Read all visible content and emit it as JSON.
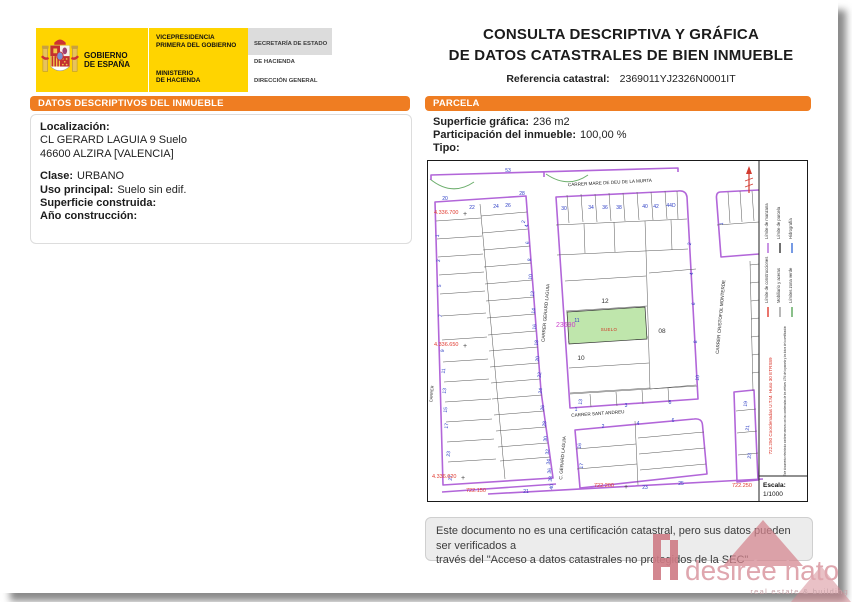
{
  "header": {
    "agency": {
      "gobierno": "GOBIERNO\nDE ESPAÑA",
      "vicepresidencia": "VICEPRESIDENCIA\nPRIMERA DEL GOBIERNO",
      "ministerio": "MINISTERIO\nDE HACIENDA",
      "secretaria": "SECRETARÍA DE ESTADO\nDE HACIENDA",
      "direccion": "DIRECCIÓN GENERAL\nDEL CATASTRO"
    },
    "title_line1": "CONSULTA DESCRIPTIVA Y GRÁFICA",
    "title_line2": "DE DATOS CATASTRALES DE BIEN INMUEBLE",
    "referencia_label": "Referencia catastral:",
    "referencia_value": "2369011YJ2326N0001IT"
  },
  "datos": {
    "title": "DATOS DESCRIPTIVOS DEL INMUEBLE",
    "localizacion_label": "Localización:",
    "direccion_line1": "CL GERARD LAGUIA 9 Suelo",
    "direccion_line2": "46600 ALZIRA [VALENCIA]",
    "clase_label": "Clase:",
    "clase_value": "URBANO",
    "uso_label": "Uso principal:",
    "uso_value": "Suelo sin edif.",
    "superficie_label": "Superficie construida:",
    "superficie_value": "",
    "anio_label": "Año construcción:",
    "anio_value": ""
  },
  "parcela": {
    "title": "PARCELA",
    "superficie_label": "Superficie gráfica:",
    "superficie_value": "236 m2",
    "participacion_label": "Participación del inmueble:",
    "participacion_value": "100,00 %",
    "tipo_label": "Tipo:",
    "tipo_value": ""
  },
  "map": {
    "scale_label": "Escala:",
    "scale_value": "1/1000",
    "side_note_red": "722.250 Coordenadas U.T.M. Huso 30 ETRS89",
    "side_note_black": "Este documento electrónico contiene anexos con las coordenadas de los vértices UTM de la parcela y los datos de la certificación",
    "legend": [
      {
        "label": "Límite de manzana",
        "color": "#b266d9"
      },
      {
        "label": "Límite de construcciones",
        "color": "#e03a2f"
      },
      {
        "label": "Límite de parcela",
        "color": "#333333"
      },
      {
        "label": "Mobiliario y aceras",
        "color": "#999999"
      },
      {
        "label": "Hidrografía",
        "color": "#3b6fd8"
      },
      {
        "label": "Límites zona verde",
        "color": "#57a657"
      }
    ],
    "labels": [
      {
        "t": "CARRER MARE DE DEU DE LA MURTA",
        "x": 182,
        "y": 23,
        "r": -3,
        "c": "street"
      },
      {
        "t": "CARRER GERARD LAGUIA",
        "x": 119,
        "y": 152,
        "r": -85,
        "c": "street"
      },
      {
        "t": "CARRER CRISTOFOL MONTERDE",
        "x": 294,
        "y": 156,
        "r": -85,
        "c": "street"
      },
      {
        "t": "CARRER SANT ANDREU",
        "x": 170,
        "y": 254,
        "r": -4,
        "c": "street"
      },
      {
        "t": "C. GERARD LAGUIA",
        "x": 136,
        "y": 297,
        "r": -85,
        "c": "street"
      },
      {
        "t": "CARRER",
        "x": 5,
        "y": 233,
        "r": -85,
        "c": "street",
        "s": 4
      },
      {
        "t": "53",
        "x": 80,
        "y": 11
      },
      {
        "t": "20",
        "x": 17,
        "y": 39
      },
      {
        "t": "28",
        "x": 94,
        "y": 34
      },
      {
        "t": "22",
        "x": 44,
        "y": 48
      },
      {
        "t": "24",
        "x": 68,
        "y": 47
      },
      {
        "t": "26",
        "x": 80,
        "y": 46
      },
      {
        "t": "2",
        "x": 97,
        "y": 61,
        "r": -80
      },
      {
        "t": "1",
        "x": 11,
        "y": 75,
        "r": -84
      },
      {
        "t": "3",
        "x": 12,
        "y": 100,
        "r": -84
      },
      {
        "t": "5",
        "x": 13,
        "y": 125,
        "r": -84
      },
      {
        "t": "7",
        "x": 14,
        "y": 155,
        "r": -84
      },
      {
        "t": "9",
        "x": 16,
        "y": 190,
        "r": -84
      },
      {
        "t": "11",
        "x": 17,
        "y": 210,
        "r": -84
      },
      {
        "t": "13",
        "x": 18,
        "y": 230,
        "r": -84
      },
      {
        "t": "15",
        "x": 19,
        "y": 249,
        "r": -84
      },
      {
        "t": "17",
        "x": 20,
        "y": 265,
        "r": -84
      },
      {
        "t": "23",
        "x": 22,
        "y": 293,
        "r": -84
      },
      {
        "t": "27",
        "x": 24,
        "y": 317,
        "r": -84
      },
      {
        "t": "4",
        "x": 100,
        "y": 65,
        "r": -84
      },
      {
        "t": "6",
        "x": 101,
        "y": 82,
        "r": -84
      },
      {
        "t": "8",
        "x": 103,
        "y": 99,
        "r": -84
      },
      {
        "t": "10",
        "x": 104,
        "y": 116,
        "r": -84
      },
      {
        "t": "12",
        "x": 106,
        "y": 133,
        "r": -84
      },
      {
        "t": "14",
        "x": 107,
        "y": 150,
        "r": -84
      },
      {
        "t": "16",
        "x": 108,
        "y": 166,
        "r": -84
      },
      {
        "t": "18",
        "x": 110,
        "y": 182,
        "r": -84
      },
      {
        "t": "20",
        "x": 111,
        "y": 198,
        "r": -84
      },
      {
        "t": "22",
        "x": 113,
        "y": 214,
        "r": -84
      },
      {
        "t": "24",
        "x": 114,
        "y": 230,
        "r": -84
      },
      {
        "t": "26",
        "x": 116,
        "y": 247,
        "r": -84
      },
      {
        "t": "28",
        "x": 118,
        "y": 263,
        "r": -84
      },
      {
        "t": "30",
        "x": 119,
        "y": 278,
        "r": -84
      },
      {
        "t": "32",
        "x": 121,
        "y": 291,
        "r": -84
      },
      {
        "t": "34",
        "x": 122,
        "y": 301,
        "r": -84
      },
      {
        "t": "36",
        "x": 123,
        "y": 310,
        "r": -84
      },
      {
        "t": "38",
        "x": 124,
        "y": 318,
        "r": -84
      },
      {
        "t": "40",
        "x": 125,
        "y": 326,
        "r": -84
      },
      {
        "t": "30",
        "x": 136,
        "y": 49
      },
      {
        "t": "34",
        "x": 163,
        "y": 48
      },
      {
        "t": "36",
        "x": 177,
        "y": 48
      },
      {
        "t": "38",
        "x": 191,
        "y": 48
      },
      {
        "t": "40",
        "x": 217,
        "y": 47
      },
      {
        "t": "42",
        "x": 228,
        "y": 47
      },
      {
        "t": "44D",
        "x": 243,
        "y": 46
      },
      {
        "t": "2",
        "x": 263,
        "y": 83,
        "r": -84
      },
      {
        "t": "4",
        "x": 265,
        "y": 113,
        "r": -84
      },
      {
        "t": "6",
        "x": 267,
        "y": 143,
        "r": -84
      },
      {
        "t": "8",
        "x": 269,
        "y": 181,
        "r": -84
      },
      {
        "t": "10",
        "x": 271,
        "y": 217,
        "r": -84
      },
      {
        "t": "11",
        "x": 149,
        "y": 161
      },
      {
        "t": "13",
        "x": 154,
        "y": 241,
        "r": -84
      },
      {
        "t": "1",
        "x": 148,
        "y": 250
      },
      {
        "t": "3",
        "x": 198,
        "y": 246
      },
      {
        "t": "5",
        "x": 242,
        "y": 243
      },
      {
        "t": "1",
        "x": 295,
        "y": 63,
        "r": -84
      },
      {
        "t": "2",
        "x": 175,
        "y": 267
      },
      {
        "t": "4",
        "x": 210,
        "y": 264
      },
      {
        "t": "6",
        "x": 245,
        "y": 261
      },
      {
        "t": "16",
        "x": 153,
        "y": 285,
        "r": -84
      },
      {
        "t": "17",
        "x": 155,
        "y": 305,
        "r": -84
      },
      {
        "t": "19",
        "x": 319,
        "y": 243,
        "r": -84
      },
      {
        "t": "21",
        "x": 321,
        "y": 267,
        "r": -84
      },
      {
        "t": "23",
        "x": 323,
        "y": 295,
        "r": -84
      },
      {
        "t": "21",
        "x": 98,
        "y": 332
      },
      {
        "t": "23",
        "x": 217,
        "y": 328
      },
      {
        "t": "25",
        "x": 253,
        "y": 324
      },
      {
        "t": "12",
        "x": 177,
        "y": 142,
        "c": "pid"
      },
      {
        "t": "10",
        "x": 153,
        "y": 199,
        "c": "pid"
      },
      {
        "t": "08",
        "x": 234,
        "y": 172,
        "c": "pid"
      },
      {
        "t": "23690",
        "x": 128,
        "y": 166,
        "c": "blk",
        "a": "s"
      },
      {
        "t": "SUELO",
        "x": 181,
        "y": 170,
        "c": "suelo"
      },
      {
        "t": "4.336.700",
        "x": 6,
        "y": 53,
        "c": "coord",
        "a": "s"
      },
      {
        "t": "4.336.650",
        "x": 6,
        "y": 185,
        "c": "coord",
        "a": "s"
      },
      {
        "t": "4.336.620",
        "x": 4,
        "y": 317,
        "c": "coord",
        "a": "s"
      },
      {
        "t": "722.150",
        "x": 38,
        "y": 331,
        "c": "coord",
        "a": "s"
      },
      {
        "t": "722.200",
        "x": 166,
        "y": 326,
        "c": "coord",
        "a": "s"
      },
      {
        "t": "722.250",
        "x": 304,
        "y": 326,
        "c": "coord",
        "a": "s"
      },
      {
        "t": "+",
        "x": 37,
        "y": 55,
        "c": "cross"
      },
      {
        "t": "+",
        "x": 37,
        "y": 187,
        "c": "cross"
      },
      {
        "t": "+",
        "x": 35,
        "y": 319,
        "c": "cross"
      },
      {
        "t": "+",
        "x": 198,
        "y": 328,
        "c": "cross"
      }
    ]
  },
  "footer": {
    "disclaimer_line1": "Este documento no es una certificación catastral, pero sus datos pueden ser verificados a",
    "disclaimer_line2": "través del \"Acceso a datos catastrales no protegidos de la SEC\"",
    "brand_name": "desirée hato",
    "brand_tagline": "real estate & building"
  }
}
